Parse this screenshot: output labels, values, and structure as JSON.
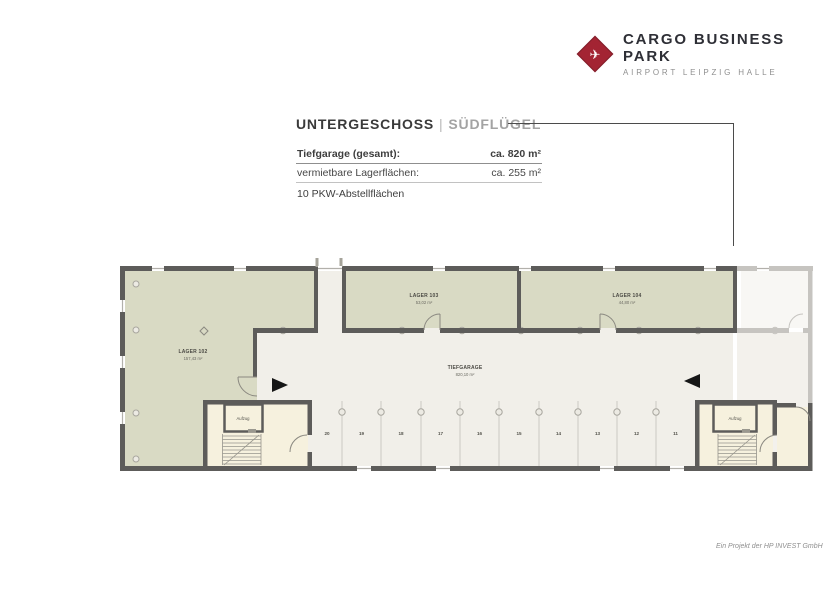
{
  "brand": {
    "name": "CARGO BUSINESS PARK",
    "tagline": "AIRPORT LEIPZIG HALLE",
    "logo_icon": "airplane-icon",
    "logo_color": "#a32433"
  },
  "title": {
    "floor": "UNTERGESCHOSS",
    "separator": "|",
    "wing": "SÜDFLÜGEL"
  },
  "summary": {
    "row1_label": "Tiefgarage (gesamt):",
    "row1_value": "ca. 820 m²",
    "row2_label": "vermietbare Lagerflächen:",
    "row2_value": "ca. 255 m²",
    "row3_label": "10 PKW-Abstellflächen"
  },
  "plan": {
    "rooms": [
      {
        "name": "LAGER 102",
        "area": "157,43 m²"
      },
      {
        "name": "LAGER 103",
        "area": "53,02 m²"
      },
      {
        "name": "LAGER 104",
        "area": "44,80 m²"
      },
      {
        "name": "TIEFGARAGE",
        "area": "820,10 m²"
      }
    ],
    "elevator_label": "Aufzug",
    "parking_spaces": [
      "20",
      "19",
      "18",
      "17",
      "16",
      "15",
      "14",
      "13",
      "12",
      "11"
    ],
    "colors": {
      "storage": "#d9dac4",
      "garage": "#f1efe9",
      "stairwell": "#f6f1de",
      "wall": "#5d5c5a",
      "faded": "#c6c4c0"
    }
  },
  "footer": {
    "credit": "Ein Projekt der HP INVEST GmbH"
  }
}
